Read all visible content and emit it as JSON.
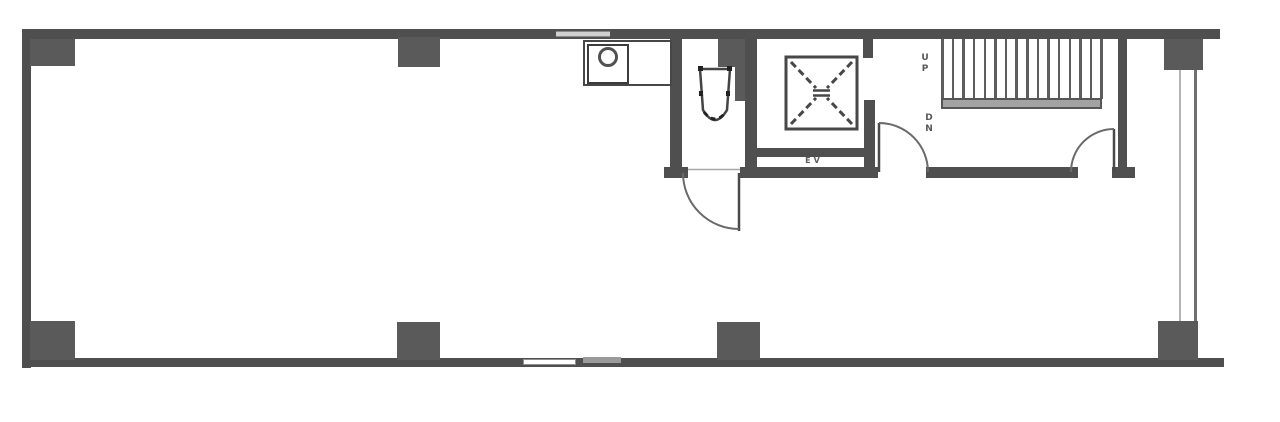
{
  "labels": {
    "stairs_up": "UP",
    "stairs_down": "DN",
    "elevator": "EV"
  },
  "stairs": {
    "tread_count": 16
  },
  "colors": {
    "wall": "#4f4f4f",
    "column": "#5a5a5a",
    "line": "#3d3d3d",
    "window_inner": "#b4b4b4",
    "window_outer": "#707070",
    "landing": "#a3a3a3",
    "paper": "#ffffff",
    "label": "#2e2e2e"
  }
}
